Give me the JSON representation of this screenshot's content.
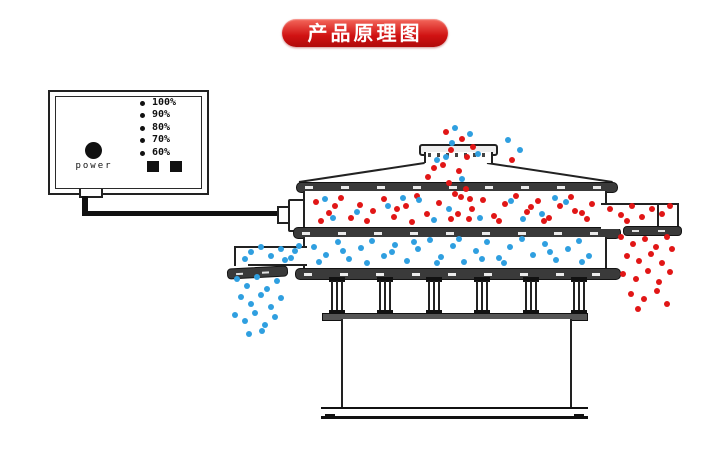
{
  "title_badge": {
    "label": "产品原理图",
    "bg": "#d01212",
    "text_color": "#ffffff"
  },
  "control_box": {
    "power_label": "power",
    "levels": [
      "100%",
      "90%",
      "80%",
      "70%",
      "60%"
    ],
    "buttons": [
      "square-button",
      "square-button"
    ]
  },
  "particles": {
    "red": "#e11616",
    "blue": "#2f9fe0",
    "groups": [
      {
        "name": "inlet-stream-red",
        "color": "red",
        "points": [
          [
            446,
            132
          ],
          [
            462,
            139
          ],
          [
            451,
            150
          ],
          [
            467,
            157
          ],
          [
            443,
            165
          ],
          [
            459,
            171
          ],
          [
            449,
            183
          ],
          [
            466,
            189
          ],
          [
            473,
            147
          ],
          [
            434,
            168
          ],
          [
            428,
            177
          ],
          [
            512,
            160
          ],
          [
            455,
            194
          ],
          [
            470,
            199
          ]
        ]
      },
      {
        "name": "inlet-stream-blue",
        "color": "blue",
        "points": [
          [
            455,
            128
          ],
          [
            470,
            134
          ],
          [
            478,
            154
          ],
          [
            446,
            157
          ],
          [
            462,
            179
          ],
          [
            437,
            160
          ],
          [
            508,
            140
          ],
          [
            520,
            150
          ],
          [
            452,
            143
          ]
        ]
      },
      {
        "name": "upper-deck-red",
        "color": "red",
        "points": [
          [
            316,
            202
          ],
          [
            329,
            213
          ],
          [
            341,
            198
          ],
          [
            351,
            218
          ],
          [
            360,
            205
          ],
          [
            373,
            211
          ],
          [
            384,
            199
          ],
          [
            394,
            217
          ],
          [
            406,
            206
          ],
          [
            417,
            196
          ],
          [
            427,
            214
          ],
          [
            439,
            203
          ],
          [
            451,
            219
          ],
          [
            461,
            197
          ],
          [
            472,
            209
          ],
          [
            483,
            200
          ],
          [
            494,
            216
          ],
          [
            505,
            204
          ],
          [
            516,
            196
          ],
          [
            527,
            212
          ],
          [
            538,
            201
          ],
          [
            549,
            218
          ],
          [
            560,
            206
          ],
          [
            571,
            197
          ],
          [
            582,
            213
          ],
          [
            592,
            204
          ],
          [
            321,
            221
          ],
          [
            367,
            221
          ],
          [
            412,
            222
          ],
          [
            458,
            214
          ],
          [
            499,
            221
          ],
          [
            544,
            221
          ],
          [
            587,
            219
          ],
          [
            335,
            206
          ],
          [
            397,
            209
          ],
          [
            469,
            219
          ],
          [
            531,
            207
          ],
          [
            575,
            211
          ]
        ]
      },
      {
        "name": "upper-deck-blue",
        "color": "blue",
        "points": [
          [
            325,
            199
          ],
          [
            357,
            212
          ],
          [
            388,
            206
          ],
          [
            419,
            200
          ],
          [
            449,
            209
          ],
          [
            480,
            218
          ],
          [
            511,
            201
          ],
          [
            542,
            214
          ],
          [
            566,
            202
          ],
          [
            333,
            218
          ],
          [
            403,
            198
          ],
          [
            434,
            220
          ],
          [
            523,
            219
          ],
          [
            555,
            198
          ]
        ]
      },
      {
        "name": "right-outlet-red",
        "color": "red",
        "points": [
          [
            610,
            209
          ],
          [
            621,
            215
          ],
          [
            632,
            206
          ],
          [
            642,
            217
          ],
          [
            652,
            209
          ],
          [
            662,
            214
          ],
          [
            670,
            206
          ],
          [
            627,
            221
          ]
        ]
      },
      {
        "name": "right-falling-red",
        "color": "red",
        "points": [
          [
            621,
            237
          ],
          [
            633,
            244
          ],
          [
            645,
            239
          ],
          [
            656,
            247
          ],
          [
            667,
            237
          ],
          [
            627,
            256
          ],
          [
            639,
            261
          ],
          [
            651,
            254
          ],
          [
            662,
            263
          ],
          [
            672,
            249
          ],
          [
            623,
            274
          ],
          [
            636,
            279
          ],
          [
            648,
            271
          ],
          [
            659,
            282
          ],
          [
            670,
            272
          ],
          [
            631,
            294
          ],
          [
            644,
            299
          ],
          [
            657,
            291
          ],
          [
            667,
            304
          ],
          [
            638,
            309
          ]
        ]
      },
      {
        "name": "lower-deck-blue",
        "color": "blue",
        "points": [
          [
            314,
            247
          ],
          [
            326,
            255
          ],
          [
            338,
            242
          ],
          [
            349,
            259
          ],
          [
            361,
            248
          ],
          [
            372,
            241
          ],
          [
            384,
            256
          ],
          [
            395,
            245
          ],
          [
            407,
            261
          ],
          [
            418,
            249
          ],
          [
            430,
            240
          ],
          [
            441,
            257
          ],
          [
            453,
            246
          ],
          [
            464,
            262
          ],
          [
            476,
            251
          ],
          [
            487,
            242
          ],
          [
            499,
            258
          ],
          [
            510,
            247
          ],
          [
            522,
            239
          ],
          [
            533,
            255
          ],
          [
            545,
            244
          ],
          [
            556,
            260
          ],
          [
            568,
            249
          ],
          [
            579,
            241
          ],
          [
            589,
            256
          ],
          [
            319,
            262
          ],
          [
            367,
            263
          ],
          [
            414,
            242
          ],
          [
            459,
            239
          ],
          [
            504,
            263
          ],
          [
            550,
            252
          ],
          [
            582,
            262
          ],
          [
            343,
            251
          ],
          [
            392,
            252
          ],
          [
            437,
            263
          ],
          [
            482,
            259
          ]
        ]
      },
      {
        "name": "left-chute-blue",
        "color": "blue",
        "points": [
          [
            251,
            252
          ],
          [
            261,
            247
          ],
          [
            271,
            256
          ],
          [
            281,
            249
          ],
          [
            291,
            258
          ],
          [
            299,
            246
          ],
          [
            245,
            259
          ],
          [
            285,
            260
          ],
          [
            295,
            251
          ]
        ]
      },
      {
        "name": "left-falling-blue",
        "color": "blue",
        "points": [
          [
            237,
            279
          ],
          [
            247,
            286
          ],
          [
            257,
            277
          ],
          [
            267,
            289
          ],
          [
            277,
            281
          ],
          [
            241,
            297
          ],
          [
            251,
            304
          ],
          [
            261,
            295
          ],
          [
            271,
            307
          ],
          [
            281,
            298
          ],
          [
            235,
            315
          ],
          [
            245,
            321
          ],
          [
            255,
            313
          ],
          [
            265,
            325
          ],
          [
            275,
            317
          ],
          [
            249,
            334
          ],
          [
            262,
            331
          ]
        ]
      }
    ]
  }
}
